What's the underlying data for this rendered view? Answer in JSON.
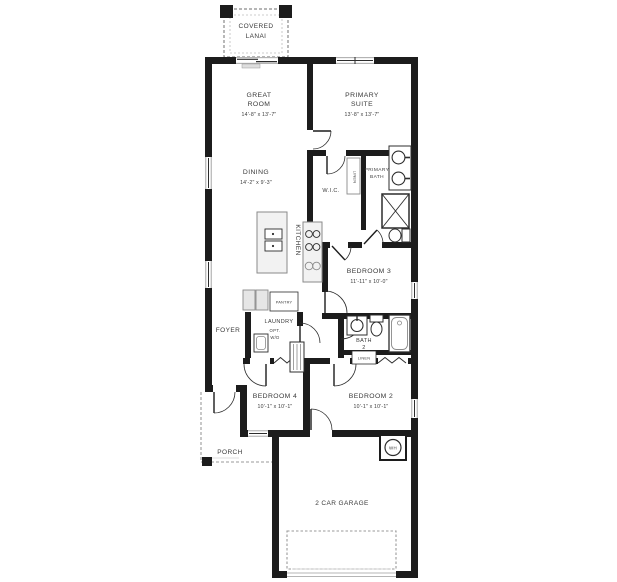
{
  "rooms": {
    "covered_lanai": {
      "line1": "COVERED",
      "line2": "LANAI"
    },
    "great_room": {
      "line1": "GREAT",
      "line2": "ROOM",
      "dims": "14'-8\" x 13'-7\""
    },
    "primary_suite": {
      "line1": "PRIMARY",
      "line2": "SUITE",
      "dims": "13'-8\" x 13'-7\""
    },
    "dining": {
      "name": "DINING",
      "dims": "14'-2\" x 9'-3\""
    },
    "kitchen": {
      "name": "KITCHEN"
    },
    "wic": {
      "name": "W.I.C."
    },
    "primary_bath": {
      "line1": "PRIMARY",
      "line2": "BATH"
    },
    "linen_primary": {
      "name": "LINEN"
    },
    "bedroom3": {
      "name": "BEDROOM 3",
      "dims": "11'-11\" x 10'-0\""
    },
    "pantry": {
      "name": "PANTRY"
    },
    "laundry": {
      "name": "LAUNDRY",
      "opt_line1": "OPT.",
      "opt_line2": "W/D"
    },
    "foyer": {
      "name": "FOYER"
    },
    "bath2": {
      "line1": "BATH",
      "line2": "2"
    },
    "linen_bath2": {
      "name": "LINEN"
    },
    "bedroom4": {
      "name": "BEDROOM 4",
      "dims": "10'-1\" x 10'-1\""
    },
    "bedroom2": {
      "name": "BEDROOM 2",
      "dims": "10'-1\" x 10'-1\""
    },
    "porch": {
      "name": "PORCH"
    },
    "garage": {
      "name": "2 CAR GARAGE"
    },
    "water_heater": {
      "abbr": "WH"
    }
  },
  "colors": {
    "wall": "#1c1c1c",
    "label": "#3a3a3a",
    "fixture": "#2d2d2d",
    "light": "#8a8a8a",
    "dashed": "#9a9a9a"
  }
}
